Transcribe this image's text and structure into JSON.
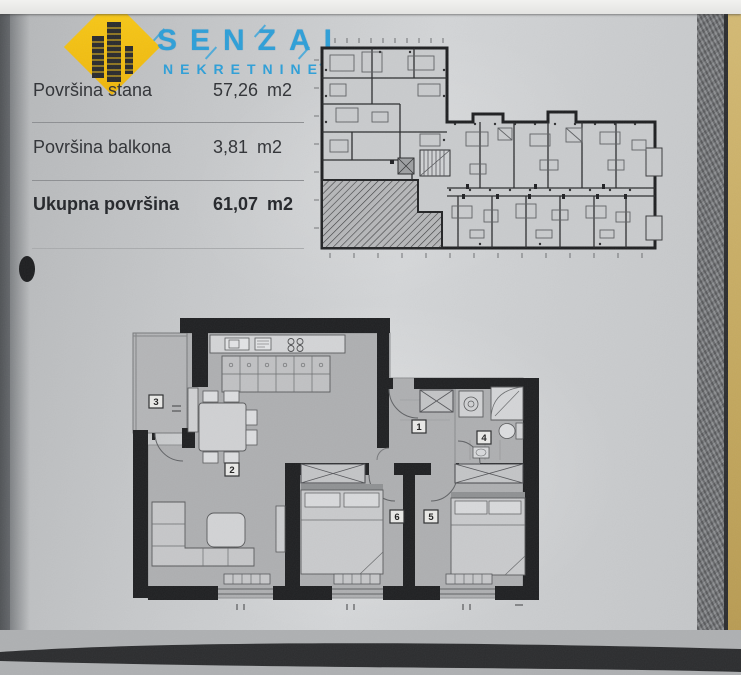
{
  "document": {
    "brand": {
      "name": "SENZAL",
      "subtitle": "NEKRETNINE",
      "colors": {
        "blue": "#2D9FD8",
        "yellow": "#F3C211"
      }
    },
    "area_table": {
      "rows": [
        {
          "label": "Površina stana",
          "value": "57,26",
          "unit": "m2"
        },
        {
          "label": "Površina balkona",
          "value": "3,81",
          "unit": "m2"
        },
        {
          "label": "Ukupna površina",
          "value": "61,07",
          "unit": "m2"
        }
      ]
    },
    "apartment_plan": {
      "room_labels": [
        "1",
        "2",
        "3",
        "4",
        "5",
        "6"
      ]
    }
  }
}
